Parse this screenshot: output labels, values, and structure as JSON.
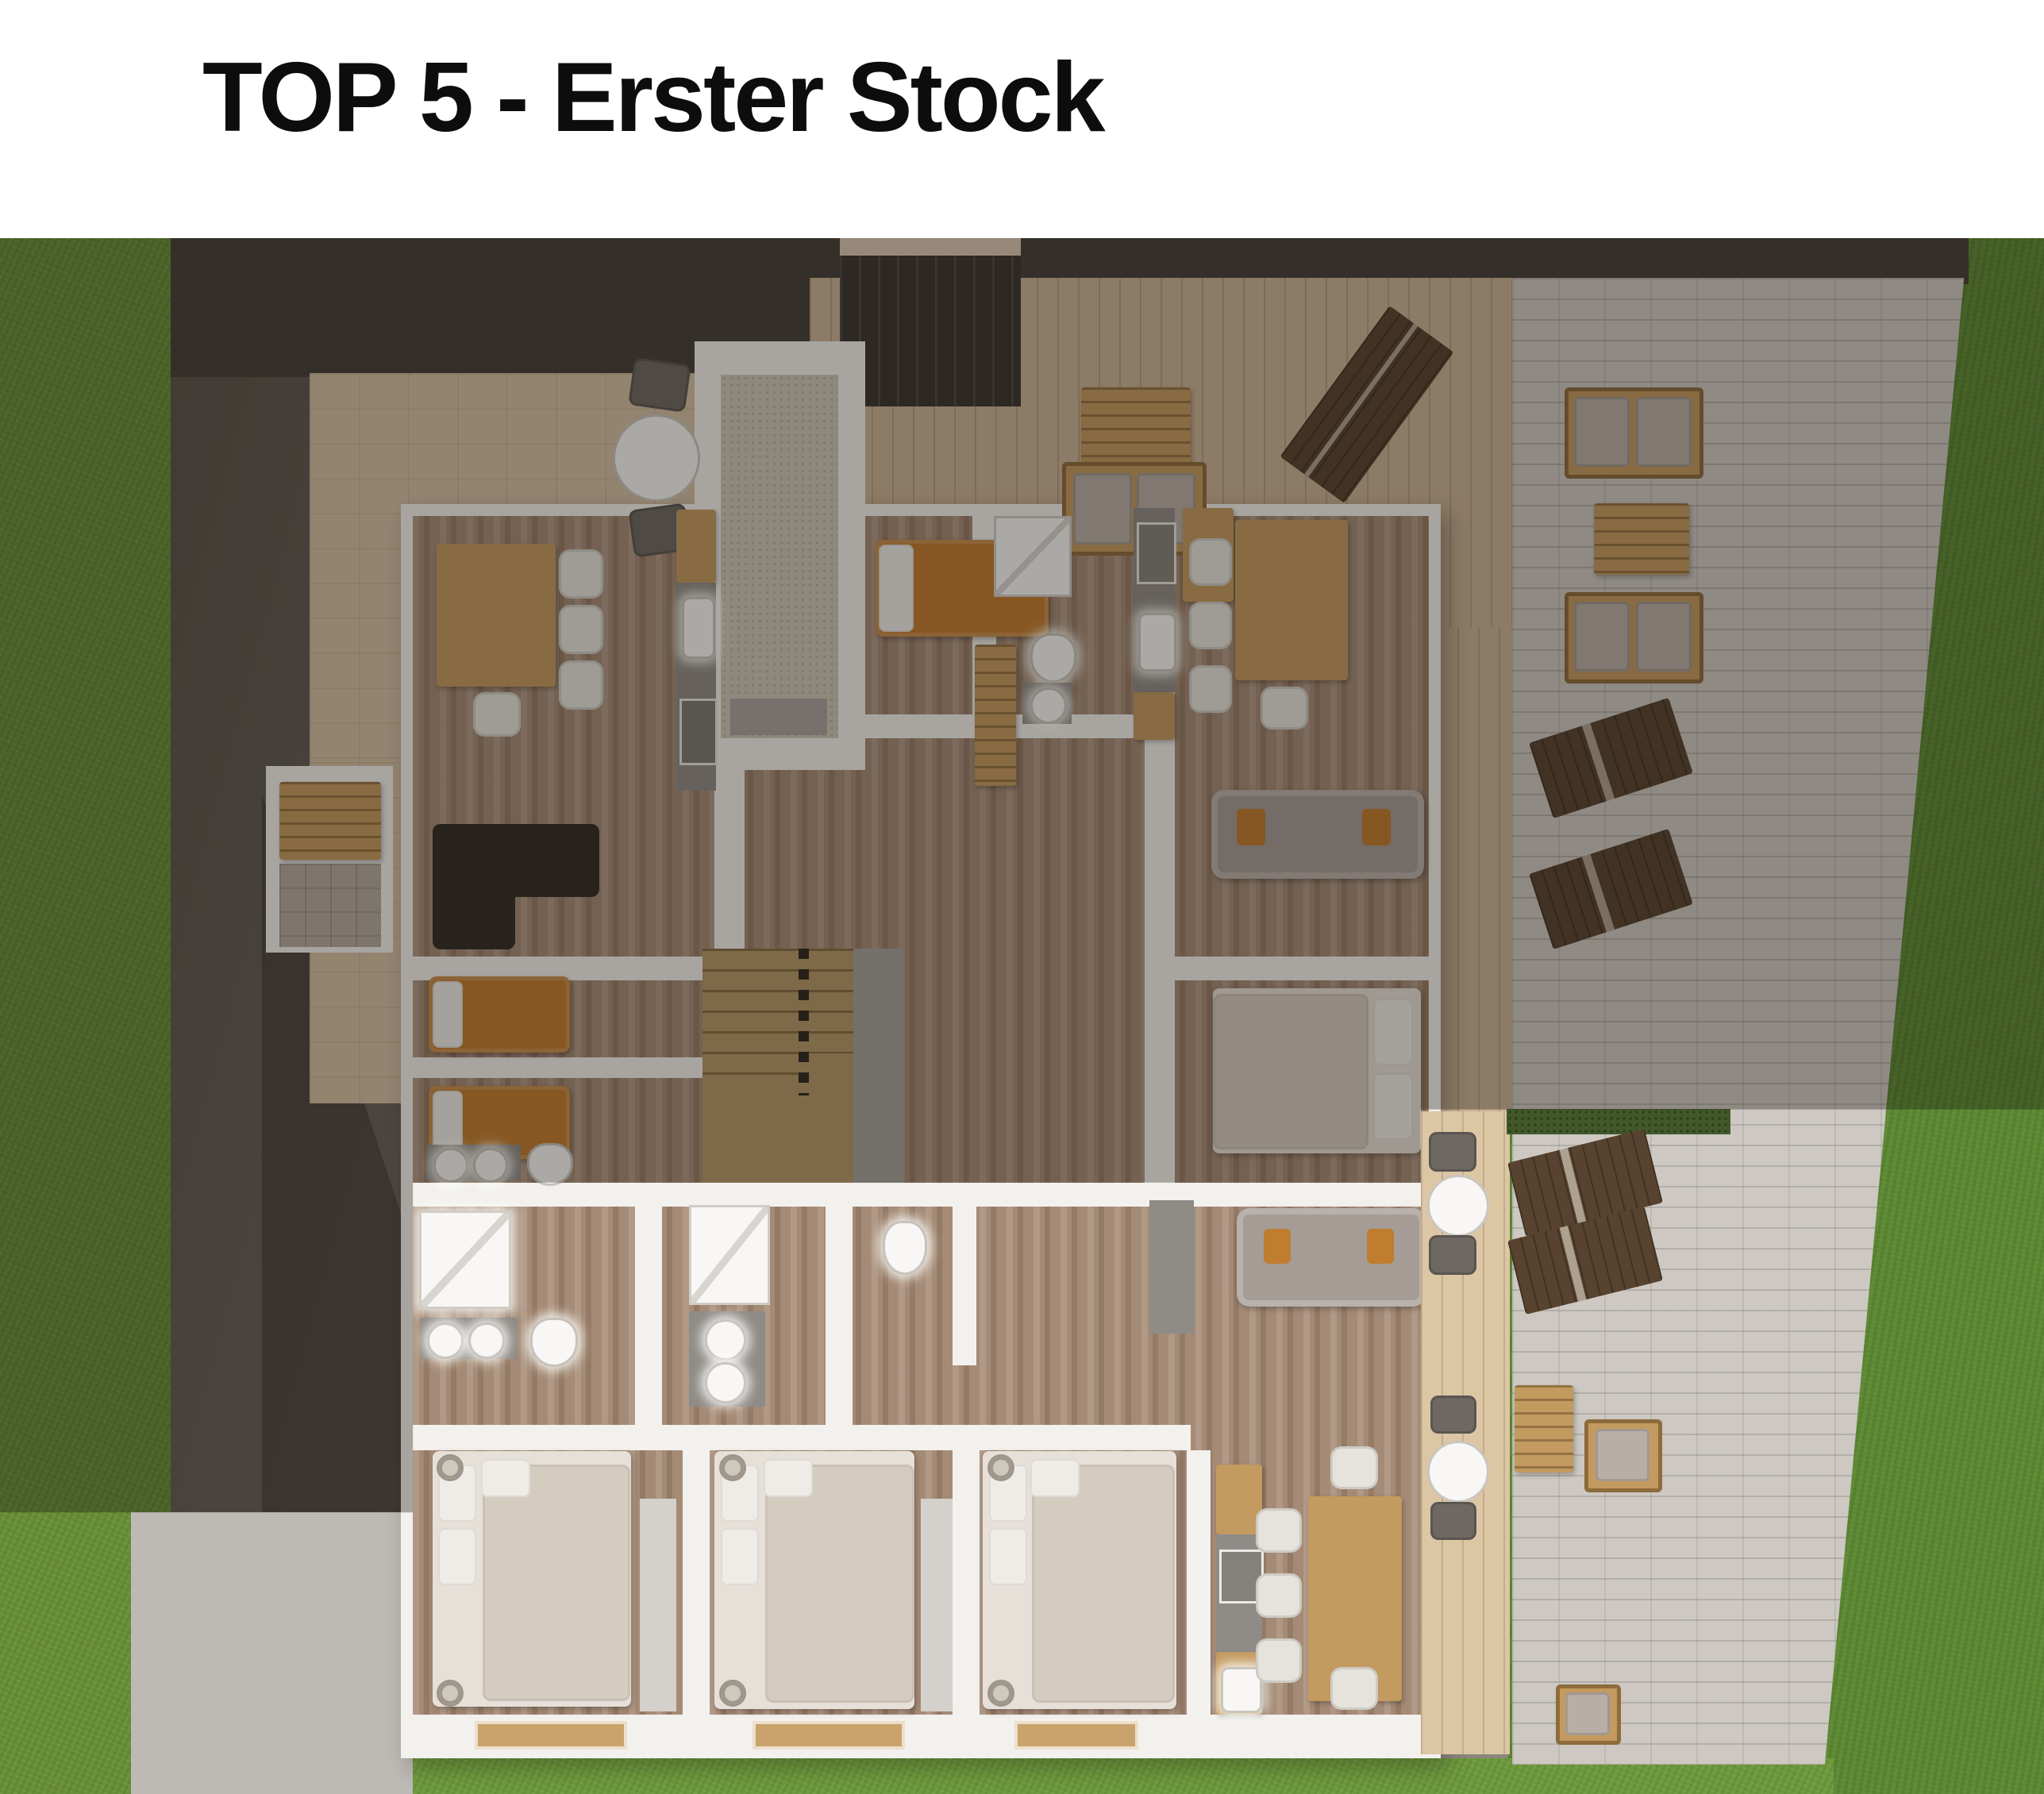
{
  "header": {
    "title": "TOP 5 - Erster Stock"
  },
  "palette": {
    "paper": "#ffffff",
    "ink": "#0d0d0d",
    "grass": "#678f37",
    "lawn": "#5d8a33",
    "grassBright": "#6d9a3c",
    "asphalt": "#5e5853",
    "pad": "#bdb9b5",
    "patio": "#cdc8c2",
    "deck": "#c9b295",
    "terrace": "#d3c0a5",
    "wall": "#f3f1ee",
    "woodMid": "#a58b76",
    "orange": "#c07c2f",
    "darkSofa": "#332c27",
    "graySofa": "#a49c95",
    "stairTan": "#b49768",
    "hedge": "#41592a",
    "lounger": "#57432f",
    "cabWood": "#c39a5f",
    "counter": "#8f8b87",
    "fixture": "#f8f7f5",
    "gravel": "#cdc7b8",
    "rug": "#d4d0cb",
    "mattress": "#e6e0d8",
    "duvet": "#d5ccc0",
    "sill": "#c9a36b",
    "dim": "rgba(22,17,12,0.34)"
  }
}
